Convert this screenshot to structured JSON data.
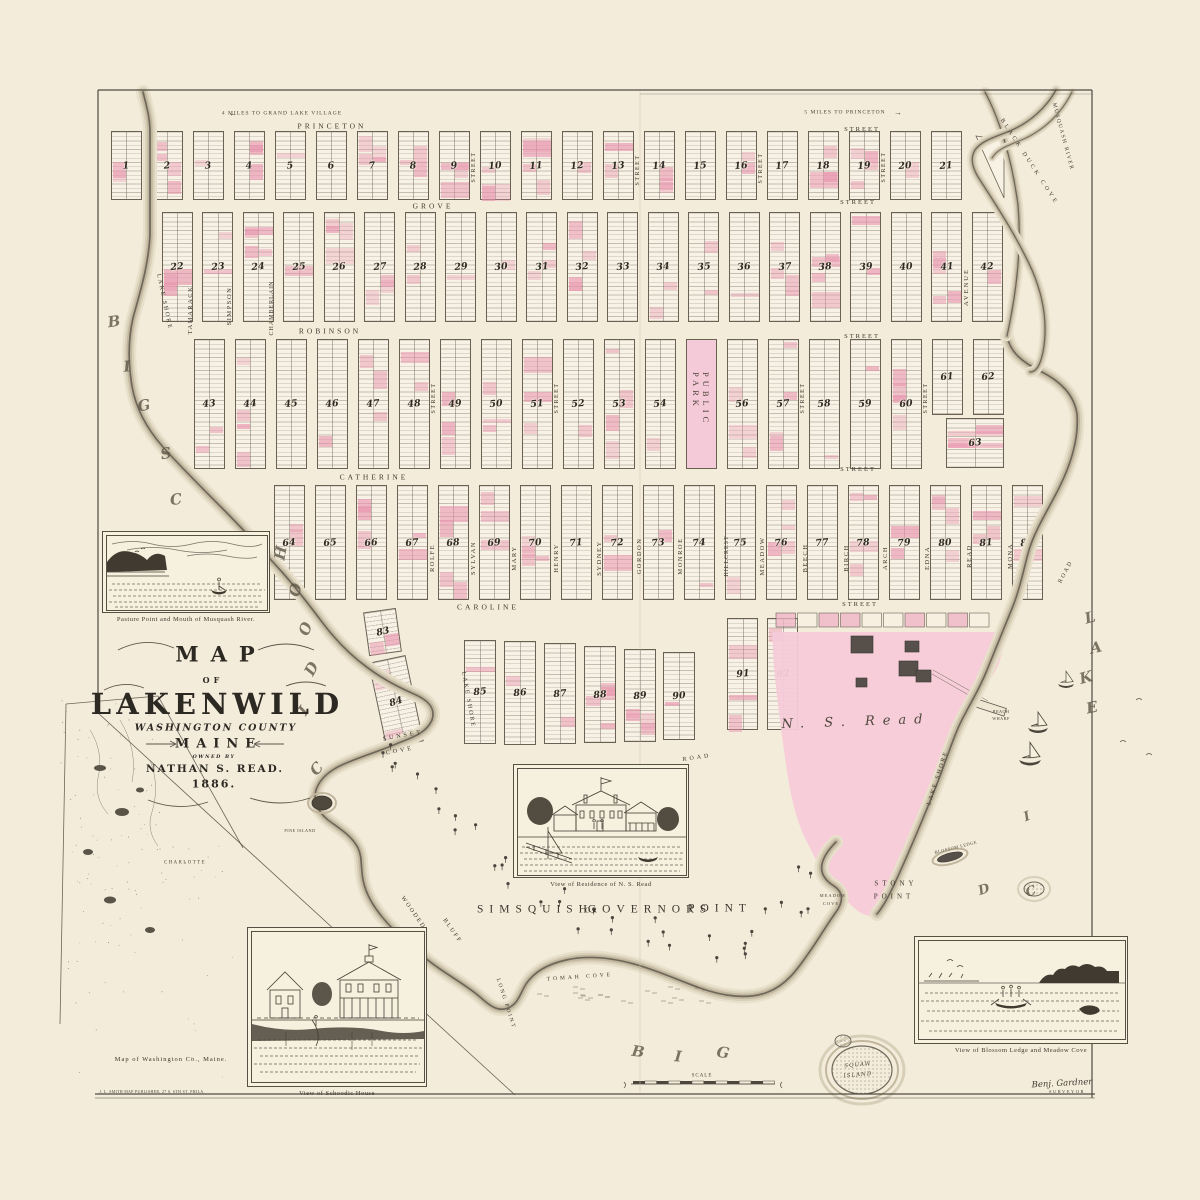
{
  "page": {
    "paper": "#f4ecdb",
    "ink": "#3a352d",
    "pink": "#e893ad",
    "estate_pink": "#f6cbd9"
  },
  "title_block": {
    "map": "MAP",
    "of": "OF",
    "name": "LAKENWILD",
    "county": "WASHINGTON COUNTY",
    "state": "MAINE",
    "owned_by": "OWNED BY",
    "owner": "NATHAN S. READ.",
    "year": "1886."
  },
  "plat": {
    "park_label": "PUBLIC PARK",
    "rows": [
      {
        "y": 131,
        "h": 69,
        "x0": 126,
        "pitch": 41,
        "w": 31,
        "numbers": [
          "1",
          "2",
          "3",
          "4",
          "5",
          "6",
          "7",
          "8",
          "9",
          "10",
          "11",
          "12",
          "13",
          "14",
          "15",
          "16",
          "17",
          "18",
          "19",
          "20",
          "21"
        ]
      },
      {
        "y": 212,
        "h": 110,
        "x0": 177,
        "pitch": 40.5,
        "w": 31,
        "numbers": [
          "22",
          "23",
          "24",
          "25",
          "26",
          "27",
          "28",
          "29",
          "30",
          "31",
          "32",
          "33",
          "34",
          "35",
          "36",
          "37",
          "38",
          "39",
          "40",
          "41",
          "42"
        ]
      },
      {
        "y": 339,
        "h": 130,
        "x0": 209,
        "pitch": 41,
        "w": 31,
        "numbers": [
          "43",
          "44",
          "45",
          "46",
          "47",
          "48",
          "49",
          "50",
          "51",
          "52",
          "53",
          "54",
          "PARK",
          "56",
          "57",
          "58",
          "59",
          "60",
          "61",
          "62"
        ],
        "short": {
          "61": 76,
          "62": 76
        }
      },
      {
        "y": 485,
        "h": 115,
        "x0": 289,
        "pitch": 41,
        "w": 31,
        "numbers": [
          "64",
          "65",
          "66",
          "67",
          "68",
          "69",
          "70",
          "71",
          "72",
          "73",
          "74",
          "75",
          "76",
          "77",
          "78",
          "79",
          "80",
          "81",
          "82"
        ]
      }
    ],
    "custom_blocks": [
      {
        "num": "63",
        "x": 946,
        "y": 418,
        "w": 58,
        "h": 50,
        "rot": 0
      },
      {
        "num": "83",
        "x": 366,
        "y": 610,
        "w": 33,
        "h": 44,
        "rot": -8
      },
      {
        "num": "84",
        "x": 377,
        "y": 658,
        "w": 38,
        "h": 88,
        "rot": -12
      },
      {
        "num": "85",
        "x": 464,
        "y": 640,
        "w": 32,
        "h": 104,
        "rot": 0
      },
      {
        "num": "86",
        "x": 504,
        "y": 641,
        "w": 32,
        "h": 104,
        "rot": 0
      },
      {
        "num": "87",
        "x": 544,
        "y": 643,
        "w": 32,
        "h": 101,
        "rot": 0
      },
      {
        "num": "88",
        "x": 584,
        "y": 646,
        "w": 32,
        "h": 97,
        "rot": 0
      },
      {
        "num": "89",
        "x": 624,
        "y": 649,
        "w": 32,
        "h": 93,
        "rot": 0
      },
      {
        "num": "90",
        "x": 663,
        "y": 652,
        "w": 32,
        "h": 88,
        "rot": 0
      },
      {
        "num": "91",
        "x": 727,
        "y": 618,
        "w": 31,
        "h": 112,
        "rot": 0
      },
      {
        "num": "92",
        "x": 767,
        "y": 618,
        "w": 31,
        "h": 112,
        "rot": 0
      }
    ]
  },
  "map_labels": [
    {
      "n": "note-left",
      "t": "4 MILES TO GRAND LAKE VILLAGE",
      "x": 282,
      "y": 114,
      "s": 5.5,
      "r": 0,
      "ls": 1,
      "f": "tiny"
    },
    {
      "n": "arrow-left-icon",
      "t": "←",
      "x": 233,
      "y": 114,
      "s": 8,
      "r": 0,
      "ls": 0,
      "f": "tiny"
    },
    {
      "n": "note-right",
      "t": "5 MILES TO PRINCETON",
      "x": 845,
      "y": 113,
      "s": 5.5,
      "r": 0,
      "ls": 1,
      "f": "tiny"
    },
    {
      "n": "arrow-right-icon",
      "t": "→",
      "x": 898,
      "y": 113,
      "s": 8,
      "r": 0,
      "ls": 0,
      "f": "tiny"
    },
    {
      "n": "street-princeton",
      "t": "PRINCETON",
      "x": 332,
      "y": 126,
      "s": 7.5,
      "r": 0,
      "ls": 3,
      "f": "st"
    },
    {
      "n": "street-princeton-suffix",
      "t": "STREET",
      "x": 862,
      "y": 130,
      "s": 6.5,
      "r": 0,
      "ls": 2,
      "f": "st"
    },
    {
      "n": "street-grove",
      "t": "GROVE",
      "x": 433,
      "y": 206,
      "s": 7.5,
      "r": 0,
      "ls": 3,
      "f": "st"
    },
    {
      "n": "street-grove-suffix",
      "t": "STREET",
      "x": 858,
      "y": 203,
      "s": 6.5,
      "r": 0,
      "ls": 2,
      "f": "st"
    },
    {
      "n": "street-robinson",
      "t": "ROBINSON",
      "x": 330,
      "y": 331,
      "s": 7.5,
      "r": 0,
      "ls": 3,
      "f": "st"
    },
    {
      "n": "street-robinson-suffix",
      "t": "STREET",
      "x": 862,
      "y": 337,
      "s": 6.5,
      "r": 0,
      "ls": 2,
      "f": "st"
    },
    {
      "n": "street-catherine",
      "t": "CATHERINE",
      "x": 374,
      "y": 477,
      "s": 7.5,
      "r": 0,
      "ls": 3,
      "f": "st"
    },
    {
      "n": "street-catherine-suffix",
      "t": "STREET",
      "x": 858,
      "y": 470,
      "s": 6.5,
      "r": 0,
      "ls": 2,
      "f": "st"
    },
    {
      "n": "street-caroline",
      "t": "CAROLINE",
      "x": 488,
      "y": 607,
      "s": 7.5,
      "r": 0,
      "ls": 3,
      "f": "st"
    },
    {
      "n": "street-caroline-suffix",
      "t": "STREET",
      "x": 860,
      "y": 605,
      "s": 6.5,
      "r": 0,
      "ls": 2,
      "f": "st"
    },
    {
      "n": "street-lake-shore-nw",
      "t": "LAKE SHORE",
      "x": 164,
      "y": 302,
      "s": 6,
      "r": 78,
      "ls": 2,
      "f": "st"
    },
    {
      "n": "street-tamarack",
      "t": "TAMARACK",
      "x": 191,
      "y": 310,
      "s": 6.5,
      "r": -90,
      "ls": 1.5,
      "f": "st"
    },
    {
      "n": "street-simpson",
      "t": "SIMPSON",
      "x": 230,
      "y": 306,
      "s": 6.5,
      "r": -90,
      "ls": 1.5,
      "f": "st"
    },
    {
      "n": "street-chamberlain",
      "t": "CHAMBERLAIN",
      "x": 272,
      "y": 308,
      "s": 6,
      "r": -90,
      "ls": 1,
      "f": "st"
    },
    {
      "n": "street-v1",
      "t": "STREET",
      "x": 474,
      "y": 167,
      "s": 6,
      "r": -90,
      "ls": 1.5,
      "f": "st"
    },
    {
      "n": "street-v2",
      "t": "STREET",
      "x": 638,
      "y": 170,
      "s": 6,
      "r": -90,
      "ls": 1.5,
      "f": "st"
    },
    {
      "n": "street-v3",
      "t": "STREET",
      "x": 761,
      "y": 168,
      "s": 6,
      "r": -90,
      "ls": 1.5,
      "f": "st"
    },
    {
      "n": "street-v4",
      "t": "STREET",
      "x": 884,
      "y": 167,
      "s": 6,
      "r": -90,
      "ls": 1.5,
      "f": "st"
    },
    {
      "n": "street-avenue",
      "t": "AVENUE",
      "x": 967,
      "y": 287,
      "s": 6.5,
      "r": -90,
      "ls": 2,
      "f": "st"
    },
    {
      "n": "street-v5",
      "t": "STREET",
      "x": 434,
      "y": 398,
      "s": 6,
      "r": -90,
      "ls": 1.5,
      "f": "st"
    },
    {
      "n": "street-v6",
      "t": "STREET",
      "x": 557,
      "y": 398,
      "s": 6,
      "r": -90,
      "ls": 1.5,
      "f": "st"
    },
    {
      "n": "street-v7",
      "t": "STREET",
      "x": 803,
      "y": 398,
      "s": 6,
      "r": -90,
      "ls": 1.5,
      "f": "st"
    },
    {
      "n": "street-v8",
      "t": "STREET",
      "x": 926,
      "y": 398,
      "s": 6,
      "r": -90,
      "ls": 1.5,
      "f": "st"
    },
    {
      "n": "street-rolfe",
      "t": "ROLFE",
      "x": 433,
      "y": 558,
      "s": 6.5,
      "r": -90,
      "ls": 1.5,
      "f": "st"
    },
    {
      "n": "street-sylvan",
      "t": "SYLVAN",
      "x": 474,
      "y": 558,
      "s": 6.5,
      "r": -90,
      "ls": 1.5,
      "f": "st"
    },
    {
      "n": "street-mary",
      "t": "MARY",
      "x": 515,
      "y": 558,
      "s": 6.5,
      "r": -90,
      "ls": 1.5,
      "f": "st"
    },
    {
      "n": "street-henry",
      "t": "HENRY",
      "x": 557,
      "y": 558,
      "s": 6.5,
      "r": -90,
      "ls": 1.5,
      "f": "st"
    },
    {
      "n": "street-sydney",
      "t": "SYDNEY",
      "x": 600,
      "y": 558,
      "s": 6.5,
      "r": -90,
      "ls": 1.5,
      "f": "st"
    },
    {
      "n": "street-gordon",
      "t": "GORDON",
      "x": 640,
      "y": 556,
      "s": 6.5,
      "r": -90,
      "ls": 1.5,
      "f": "st"
    },
    {
      "n": "street-monroe",
      "t": "MONROE",
      "x": 681,
      "y": 556,
      "s": 6.5,
      "r": -90,
      "ls": 1.5,
      "f": "st"
    },
    {
      "n": "street-hillcrest",
      "t": "HILLCREST",
      "x": 727,
      "y": 556,
      "s": 6,
      "r": -90,
      "ls": 1,
      "f": "st"
    },
    {
      "n": "street-meadow",
      "t": "MEADOW",
      "x": 763,
      "y": 556,
      "s": 6.5,
      "r": -90,
      "ls": 1.5,
      "f": "st"
    },
    {
      "n": "street-beech",
      "t": "BEECH",
      "x": 806,
      "y": 558,
      "s": 6.5,
      "r": -90,
      "ls": 1.5,
      "f": "st"
    },
    {
      "n": "street-birch",
      "t": "BIRCH",
      "x": 847,
      "y": 558,
      "s": 6.5,
      "r": -90,
      "ls": 1.5,
      "f": "st"
    },
    {
      "n": "street-arch",
      "t": "ARCH",
      "x": 886,
      "y": 558,
      "s": 6.5,
      "r": -90,
      "ls": 1.5,
      "f": "st"
    },
    {
      "n": "street-edna",
      "t": "EDNA",
      "x": 928,
      "y": 558,
      "s": 6.5,
      "r": -90,
      "ls": 1.5,
      "f": "st"
    },
    {
      "n": "street-read",
      "t": "READ",
      "x": 970,
      "y": 556,
      "s": 6.5,
      "r": -90,
      "ls": 1.5,
      "f": "st"
    },
    {
      "n": "street-mona",
      "t": "MONA",
      "x": 1011,
      "y": 556,
      "s": 6.5,
      "r": -90,
      "ls": 1.5,
      "f": "st"
    },
    {
      "n": "road-ne",
      "t": "ROAD",
      "x": 1066,
      "y": 572,
      "s": 6,
      "r": -62,
      "ls": 2,
      "f": "st"
    },
    {
      "n": "street-lake-shore-se",
      "t": "LAKE SHORE",
      "x": 938,
      "y": 778,
      "s": 6,
      "r": -72,
      "ls": 2,
      "f": "st"
    },
    {
      "n": "road-south",
      "t": "ROAD",
      "x": 697,
      "y": 758,
      "s": 6,
      "r": -8,
      "ls": 3,
      "f": "st"
    },
    {
      "n": "street-lake-shore-s",
      "t": "LAKE SHORE",
      "x": 468,
      "y": 700,
      "s": 6,
      "r": 80,
      "ls": 2,
      "f": "st"
    },
    {
      "n": "water-letter",
      "t": "B",
      "x": 114,
      "y": 322,
      "s": 15,
      "r": -8,
      "ls": 0,
      "f": "wl"
    },
    {
      "n": "water-letter",
      "t": "I",
      "x": 127,
      "y": 367,
      "s": 15,
      "r": -5,
      "ls": 0,
      "f": "wl"
    },
    {
      "n": "water-letter",
      "t": "G",
      "x": 144,
      "y": 406,
      "s": 15,
      "r": -10,
      "ls": 0,
      "f": "wl"
    },
    {
      "n": "water-letter",
      "t": "S",
      "x": 166,
      "y": 454,
      "s": 15,
      "r": -12,
      "ls": 0,
      "f": "wl"
    },
    {
      "n": "water-letter",
      "t": "C",
      "x": 176,
      "y": 500,
      "s": 15,
      "r": -8,
      "ls": 0,
      "f": "wl"
    },
    {
      "n": "water-letter",
      "t": "H",
      "x": 281,
      "y": 553,
      "s": 15,
      "r": -80,
      "ls": 0,
      "f": "wl"
    },
    {
      "n": "water-letter",
      "t": "O",
      "x": 296,
      "y": 590,
      "s": 15,
      "r": -75,
      "ls": 0,
      "f": "wl"
    },
    {
      "n": "water-letter",
      "t": "O",
      "x": 306,
      "y": 629,
      "s": 15,
      "r": -70,
      "ls": 0,
      "f": "wl"
    },
    {
      "n": "water-letter",
      "t": "D",
      "x": 312,
      "y": 669,
      "s": 15,
      "r": -62,
      "ls": 0,
      "f": "wl"
    },
    {
      "n": "water-letter",
      "t": "I",
      "x": 304,
      "y": 711,
      "s": 15,
      "r": -55,
      "ls": 0,
      "f": "wl"
    },
    {
      "n": "water-letter",
      "t": "C",
      "x": 317,
      "y": 769,
      "s": 15,
      "r": -48,
      "ls": 0,
      "f": "wl"
    },
    {
      "n": "water-letter",
      "t": "B",
      "x": 638,
      "y": 1052,
      "s": 15,
      "r": 8,
      "ls": 0,
      "f": "wl"
    },
    {
      "n": "water-letter",
      "t": "I",
      "x": 678,
      "y": 1057,
      "s": 15,
      "r": 5,
      "ls": 0,
      "f": "wl"
    },
    {
      "n": "water-letter",
      "t": "G",
      "x": 723,
      "y": 1053,
      "s": 15,
      "r": 8,
      "ls": 0,
      "f": "wl"
    },
    {
      "n": "water-letter",
      "t": "L",
      "x": 1090,
      "y": 618,
      "s": 15,
      "r": -15,
      "ls": 0,
      "f": "wl"
    },
    {
      "n": "water-letter",
      "t": "A",
      "x": 1096,
      "y": 648,
      "s": 15,
      "r": -12,
      "ls": 0,
      "f": "wl"
    },
    {
      "n": "water-letter",
      "t": "K",
      "x": 1086,
      "y": 678,
      "s": 15,
      "r": -15,
      "ls": 0,
      "f": "wl"
    },
    {
      "n": "water-letter",
      "t": "E",
      "x": 1092,
      "y": 708,
      "s": 15,
      "r": -12,
      "ls": 0,
      "f": "wl"
    },
    {
      "n": "water-letter",
      "t": "I",
      "x": 1027,
      "y": 817,
      "s": 13,
      "r": -20,
      "ls": 0,
      "f": "wl"
    },
    {
      "n": "water-letter",
      "t": "D",
      "x": 984,
      "y": 890,
      "s": 13,
      "r": -18,
      "ls": 0,
      "f": "wl"
    },
    {
      "n": "water-letter",
      "t": "C",
      "x": 1031,
      "y": 892,
      "s": 13,
      "r": -20,
      "ls": 0,
      "f": "wl"
    },
    {
      "n": "cove-black-duck",
      "t": "BLACK DUCK COVE",
      "x": 1029,
      "y": 162,
      "s": 6,
      "r": 57,
      "ls": 3,
      "f": "cap"
    },
    {
      "n": "river-musquash",
      "t": "MUSQUASH RIVER",
      "x": 1062,
      "y": 137,
      "s": 5.5,
      "r": 75,
      "ls": 1.5,
      "f": "cap"
    },
    {
      "n": "cove-sunset-1",
      "t": "SUNSET",
      "x": 403,
      "y": 736,
      "s": 6,
      "r": -10,
      "ls": 3,
      "f": "cap"
    },
    {
      "n": "cove-sunset-2",
      "t": "COVE",
      "x": 400,
      "y": 751,
      "s": 6,
      "r": -10,
      "ls": 3,
      "f": "cap"
    },
    {
      "n": "island-pine",
      "t": "PINE ISLAND",
      "x": 300,
      "y": 831,
      "s": 4.2,
      "r": 0,
      "ls": 0.5,
      "f": "tiny"
    },
    {
      "n": "cove-tomah",
      "t": "TOMAH COVE",
      "x": 580,
      "y": 978,
      "s": 5.5,
      "r": -4,
      "ls": 3,
      "f": "cap"
    },
    {
      "n": "bluff-wooded-1",
      "t": "WOODED",
      "x": 413,
      "y": 913,
      "s": 6,
      "r": 55,
      "ls": 2,
      "f": "cap"
    },
    {
      "n": "bluff-wooded-2",
      "t": "BLUFF",
      "x": 452,
      "y": 931,
      "s": 6,
      "r": 55,
      "ls": 2,
      "f": "cap"
    },
    {
      "n": "point-long",
      "t": "LONG POINT",
      "x": 505,
      "y": 1004,
      "s": 5.5,
      "r": 72,
      "ls": 2,
      "f": "cap"
    },
    {
      "n": "point-simsquish-1",
      "t": "SIMSQUISH",
      "x": 535,
      "y": 910,
      "s": 11.5,
      "r": 0,
      "ls": 6,
      "f": "cap"
    },
    {
      "n": "point-simsquish-2",
      "t": "OR",
      "x": 592,
      "y": 911,
      "s": 7,
      "r": 0,
      "ls": 2,
      "f": "cap"
    },
    {
      "n": "point-simsquish-3",
      "t": "GOVERNORS",
      "x": 650,
      "y": 910,
      "s": 11.5,
      "r": 0,
      "ls": 6,
      "f": "cap"
    },
    {
      "n": "point-simsquish-4",
      "t": "POINT",
      "x": 720,
      "y": 909,
      "s": 11.5,
      "r": 0,
      "ls": 6,
      "f": "cap"
    },
    {
      "n": "point-stony-1",
      "t": "STONY",
      "x": 896,
      "y": 884,
      "s": 7,
      "r": 0,
      "ls": 4,
      "f": "cap"
    },
    {
      "n": "point-stony-2",
      "t": "POINT",
      "x": 894,
      "y": 897,
      "s": 7,
      "r": 0,
      "ls": 4,
      "f": "cap"
    },
    {
      "n": "cove-meadow-1",
      "t": "MEADOW",
      "x": 833,
      "y": 896,
      "s": 4.5,
      "r": 0,
      "ls": 1,
      "f": "tiny"
    },
    {
      "n": "cove-meadow-2",
      "t": "COVE",
      "x": 831,
      "y": 904,
      "s": 4.5,
      "r": 0,
      "ls": 1,
      "f": "tiny"
    },
    {
      "n": "ledge-blossom",
      "t": "BLOSSOM LEDGE",
      "x": 956,
      "y": 848,
      "s": 4.5,
      "r": -14,
      "ls": 0.5,
      "f": "tiny"
    },
    {
      "n": "wharf-beach-1",
      "t": "BEACH",
      "x": 1001,
      "y": 712,
      "s": 4.2,
      "r": 0,
      "ls": 0.5,
      "f": "tiny"
    },
    {
      "n": "wharf-beach-2",
      "t": "WHARF",
      "x": 1001,
      "y": 719,
      "s": 4.2,
      "r": 0,
      "ls": 0.5,
      "f": "tiny"
    },
    {
      "n": "island-squaw-1",
      "t": "SQUAW",
      "x": 858,
      "y": 1066,
      "s": 5.5,
      "r": -5,
      "ls": 1,
      "f": "it"
    },
    {
      "n": "island-squaw-2",
      "t": "ISLAND",
      "x": 858,
      "y": 1076,
      "s": 5.5,
      "r": -5,
      "ls": 1,
      "f": "it"
    },
    {
      "n": "estate-owner",
      "t": "N. S. Read",
      "x": 856,
      "y": 722,
      "s": 13,
      "r": -2,
      "ls": 8,
      "f": "owner"
    },
    {
      "n": "scale-label",
      "t": "SCALE",
      "x": 702,
      "y": 1076,
      "s": 5,
      "r": 0,
      "ls": 1,
      "f": "tiny"
    },
    {
      "n": "inset-town-charlotte",
      "t": "CHARLOTTE",
      "x": 185,
      "y": 864,
      "s": 4.8,
      "r": 0,
      "ls": 1.5,
      "f": "tiny"
    },
    {
      "n": "inset-caption",
      "t": "Map of Washington Co., Maine.",
      "x": 171,
      "y": 1060,
      "s": 6.5,
      "r": 0,
      "ls": 1,
      "f": "st"
    },
    {
      "n": "publisher-line",
      "t": "J. L. SMITH MAP PUBLISHER, 27 S. 6TH ST. PHILA.",
      "x": 152,
      "y": 1093,
      "s": 3.8,
      "r": 0,
      "ls": 0.4,
      "f": "tiny"
    },
    {
      "n": "surveyor-name",
      "t": "Benj. Gardner",
      "x": 1062,
      "y": 1084,
      "s": 8.5,
      "r": -3,
      "ls": 0,
      "f": "script"
    },
    {
      "n": "surveyor-title",
      "t": "SURVEYOR",
      "x": 1067,
      "y": 1092,
      "s": 4.5,
      "r": 0,
      "ls": 1.5,
      "f": "tiny"
    }
  ],
  "vignettes": {
    "pasture": {
      "caption": "Pasture Point and Mouth of Musquash River."
    },
    "residence": {
      "caption": "View of Residence of N. S. Read"
    },
    "schoodic": {
      "caption": "View of Schoodic House"
    },
    "blossom": {
      "caption": "View of Blossom Ledge and Meadow Cove"
    }
  }
}
